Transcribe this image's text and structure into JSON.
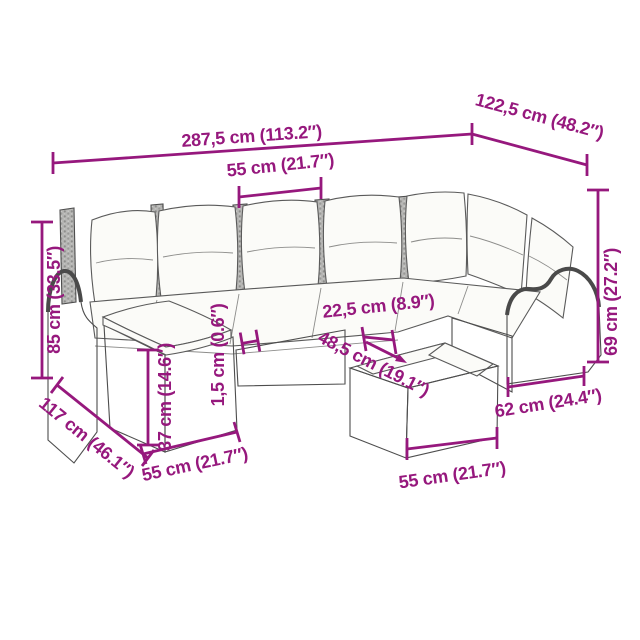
{
  "product_diagram": {
    "accent": "#96187D",
    "description": "garden-sofa-set-dimension-diagram",
    "labels": {
      "total_width": "287,5 cm (113.2″)",
      "right_depth": "122,5 cm (48.2″)",
      "seat_width": "55 cm (21.7″)",
      "back_height": "85 cm (33.5″)",
      "left_depth": "117 cm (46.1″)",
      "footstool_width": "55 cm (21.7″)",
      "footstool_height": "37 cm (14.6″)",
      "glass_top_thickness": "1,5 cm (0.6″)",
      "table_offset": "22,5 cm (8.9″)",
      "table_diagonal": "48,5 cm (19.1″)",
      "arm_height": "69 cm (27.2″)",
      "arm_depth": "62 cm (24.4″)",
      "table_width": "55 cm (21.7″)"
    }
  }
}
